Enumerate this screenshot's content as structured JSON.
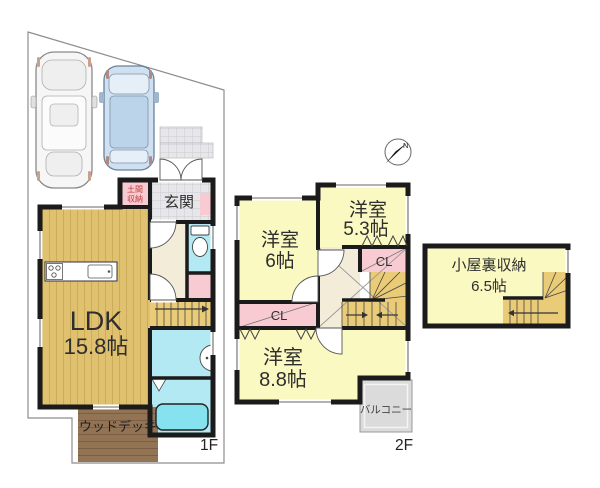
{
  "floor1": {
    "label": "1F",
    "doma_line1": "土間",
    "doma_line2": "収納",
    "genkan": "玄関",
    "ldk": "LDK",
    "ldk_size": "15.8帖",
    "deck": "ウッドデッキ"
  },
  "floor2": {
    "label": "2F",
    "room6_name": "洋室",
    "room6_size": "6帖",
    "room53_name": "洋室",
    "room53_size": "5.3帖",
    "room88_name": "洋室",
    "room88_size": "8.8帖",
    "closet_left": "CL",
    "closet_right": "CL",
    "balcony": "バルコニー"
  },
  "attic": {
    "name": "小屋裏収納",
    "size": "6.5帖"
  },
  "compass": {
    "north": "N"
  },
  "colors": {
    "room_yellow": "#FAF9C2",
    "closet_pink": "#F8CAD2",
    "wet_cyan": "#B2E9F2",
    "tub_cyan": "#85E2EE",
    "hall_cream": "#F2ECD9",
    "stair_tan": "#EACB78",
    "ldk_tan": "#DFC170",
    "deck_brown": "#927455",
    "tile_gray": "#E7E7EA",
    "balcony_gray": "#DBDBDB",
    "wall_black": "#1B1B1B",
    "doma_red": "#C23A3A"
  }
}
